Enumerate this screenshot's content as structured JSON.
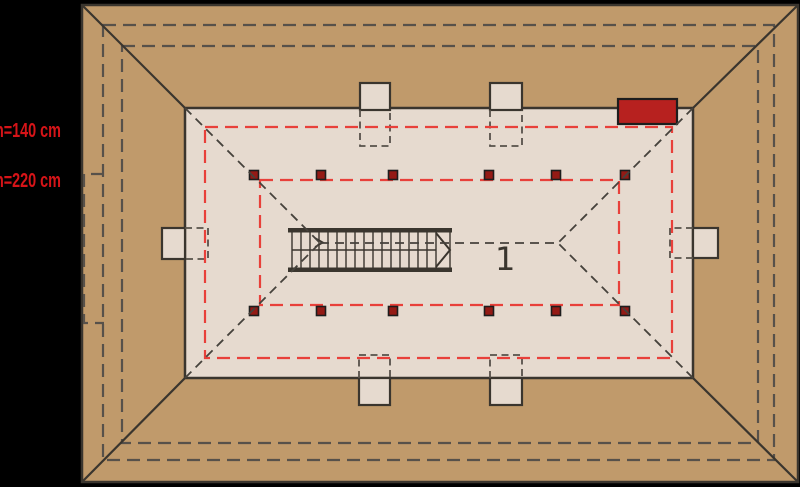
{
  "plan": {
    "room_number": "1",
    "annotations": {
      "height_line_low": "h=140 cm",
      "height_line_high": "h=220 cm"
    }
  },
  "colors": {
    "background": "#000000",
    "roof-fill": "#c09a6b",
    "floor-fill": "#e6dacf",
    "line-dark": "#3a352e",
    "dash-dark": "#57514a",
    "dash-proj": "#46423c",
    "red-dash": "#e8403a",
    "chimney-red": "#b7211f",
    "post-fill": "#941a15",
    "label-red": "#d61418",
    "number-dark": "#3a352e"
  }
}
